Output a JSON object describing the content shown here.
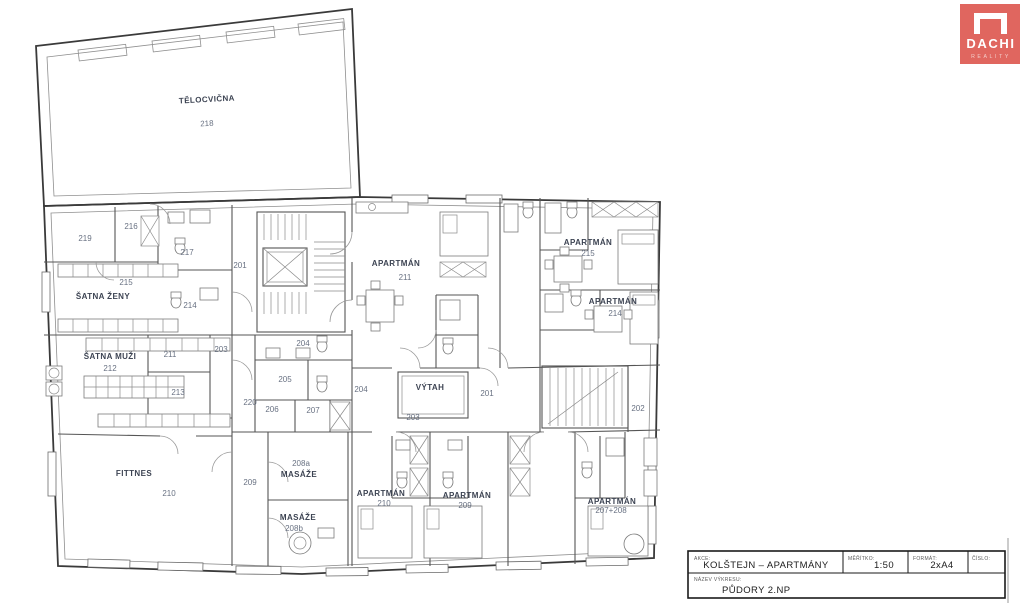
{
  "logo": {
    "brand": "DACHI",
    "sub": "REALITY",
    "color": "#e0665f"
  },
  "title_block": {
    "project_label": "AKCE:",
    "project": "KOLŠTEJN – APARTMÁNY",
    "scale_label": "MĚŘÍTKO:",
    "scale": "1:50",
    "format_label": "FORMÁT:",
    "format": "2xA4",
    "number_label": "ČÍSLO:",
    "drawing_label": "NÁZEV VÝKRESU:",
    "drawing": "PŮDORY 2.NP"
  },
  "plan": {
    "rooms": [
      {
        "name": "TĚLOCVIČNA",
        "number": "218"
      },
      {
        "number": "219"
      },
      {
        "number": "216"
      },
      {
        "number": "217"
      },
      {
        "number": "215",
        "name": "ŠATNA ŽENY"
      },
      {
        "number": "214"
      },
      {
        "number": "201"
      },
      {
        "name": "ŠATNA MUŽI",
        "number": "212"
      },
      {
        "number": "211"
      },
      {
        "number": "203"
      },
      {
        "number": "213"
      },
      {
        "number": "220"
      },
      {
        "number": "204"
      },
      {
        "number": "205"
      },
      {
        "number": "206"
      },
      {
        "number": "207"
      },
      {
        "name": "FITTNES",
        "number": "210"
      },
      {
        "number": "209"
      },
      {
        "number": "208a",
        "name": "MASÁŽE"
      },
      {
        "name": "MASÁŽE",
        "number": "208b"
      },
      {
        "name": "APARTMÁN",
        "number": "211"
      },
      {
        "number": "204"
      },
      {
        "name": "VÝTAH",
        "number": "203"
      },
      {
        "number": "201"
      },
      {
        "name": "APARTMÁN",
        "number": "215"
      },
      {
        "name": "APARTMÁN",
        "number": "214"
      },
      {
        "number": "202"
      },
      {
        "name": "APARTMÁN",
        "number": "210"
      },
      {
        "name": "APARTMÁN",
        "number": "209"
      },
      {
        "name": "APARTMÁN",
        "number": "207+208"
      }
    ]
  }
}
